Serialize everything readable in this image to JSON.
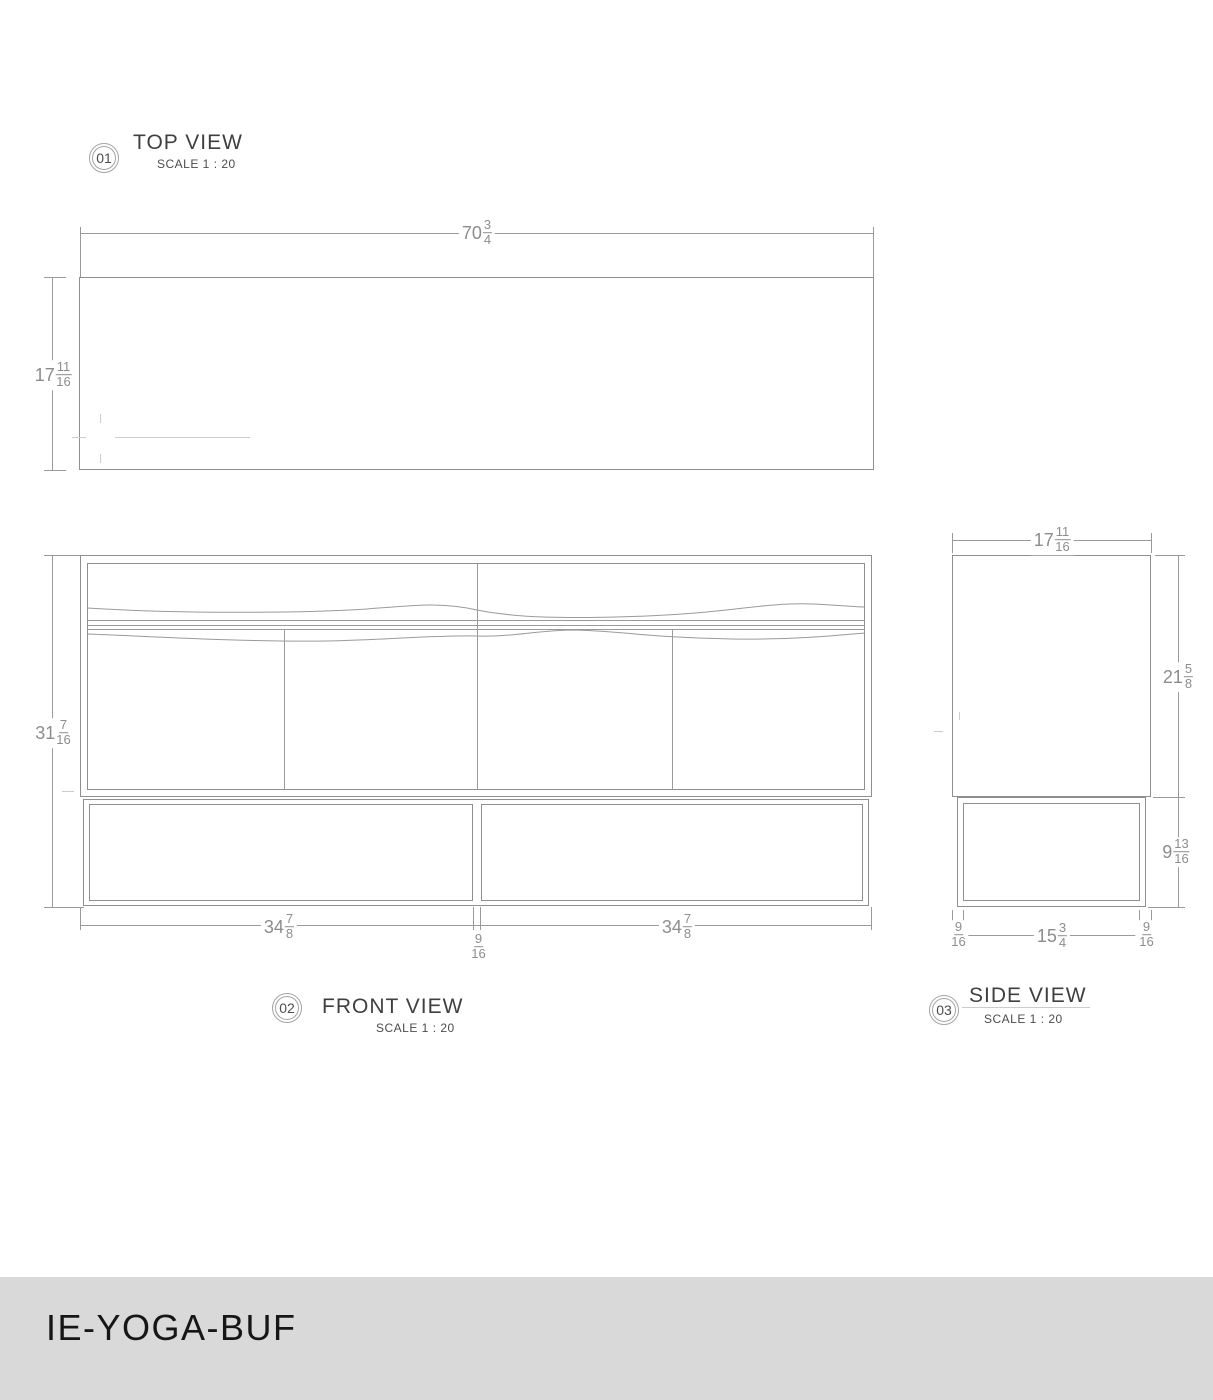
{
  "title_block": {
    "code": "IE-YOGA-BUF"
  },
  "views": {
    "top": {
      "number": "01",
      "title": "TOP VIEW",
      "scale": "SCALE 1 : 20"
    },
    "front": {
      "number": "02",
      "title": "FRONT VIEW",
      "scale": "SCALE 1 : 20"
    },
    "side": {
      "number": "03",
      "title": "SIDE VIEW",
      "scale": "SCALE 1 : 20"
    }
  },
  "dimensions": {
    "top_width": {
      "whole": "70",
      "num": "3",
      "den": "4"
    },
    "top_depth": {
      "whole": "17",
      "num": "11",
      "den": "16"
    },
    "front_height": {
      "whole": "31",
      "num": "7",
      "den": "16"
    },
    "front_left_width": {
      "whole": "34",
      "num": "7",
      "den": "8"
    },
    "front_gap": {
      "whole": "",
      "num": "9",
      "den": "16"
    },
    "front_right_width": {
      "whole": "34",
      "num": "7",
      "den": "8"
    },
    "side_width": {
      "whole": "17",
      "num": "11",
      "den": "16"
    },
    "side_upper_height": {
      "whole": "21",
      "num": "5",
      "den": "8"
    },
    "side_lower_height": {
      "whole": "9",
      "num": "13",
      "den": "16"
    },
    "side_bottom_left_gap": {
      "whole": "",
      "num": "9",
      "den": "16"
    },
    "side_bottom_width": {
      "whole": "15",
      "num": "3",
      "den": "4"
    },
    "side_bottom_right_gap": {
      "whole": "",
      "num": "9",
      "den": "16"
    }
  },
  "colors": {
    "background": "#ffffff",
    "drawing_line": "#8f8f8f",
    "dimension_text": "#8d8d8d",
    "view_title_text": "#3f3f3f",
    "titlebar_background": "#d9d9d9",
    "titlebar_text": "#161616"
  }
}
